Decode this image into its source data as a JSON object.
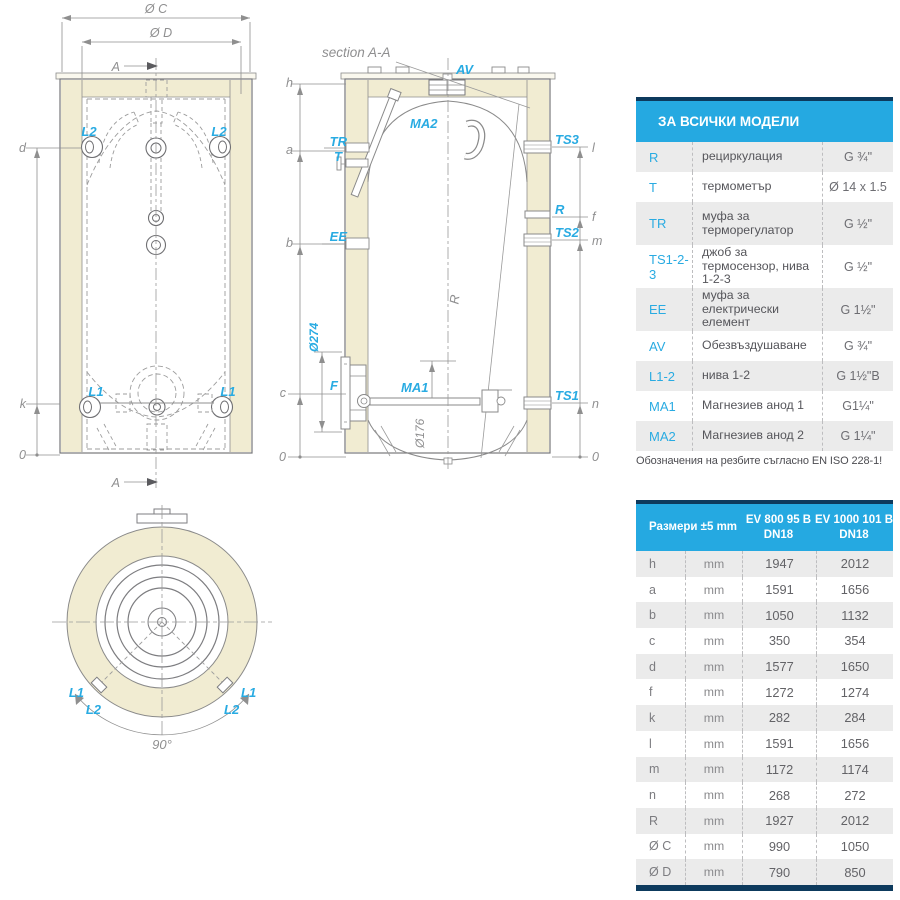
{
  "drawings": {
    "front_view": {
      "dim_c": "Ø C",
      "dim_d": "Ø D",
      "section_label": "A",
      "l2": "L2",
      "l1": "L1",
      "d": "d",
      "k": "k",
      "zero": "0"
    },
    "section_view": {
      "title": "section A-A",
      "av": "AV",
      "ma2": "MA2",
      "tr": "TR",
      "t": "T",
      "ee": "EE",
      "f_label": "F",
      "ma1": "MA1",
      "ts3": "TS3",
      "r_port": "R",
      "ts2": "TS2",
      "ts1": "TS1",
      "h": "h",
      "a": "a",
      "b": "b",
      "c": "c",
      "zero": "0",
      "l": "l",
      "f": "f",
      "m": "m",
      "n": "n",
      "r_dim": "R",
      "d274": "Ø274",
      "d176": "Ø176"
    },
    "top_view": {
      "l1": "L1",
      "l2": "L2",
      "angle": "90°"
    }
  },
  "table_models": {
    "title": "ЗА ВСИЧКИ МОДЕЛИ",
    "rows": [
      {
        "code": "R",
        "desc": "рециркулация",
        "value": "G ¾\""
      },
      {
        "code": "T",
        "desc": "термометър",
        "value": "Ø 14 x 1.5"
      },
      {
        "code": "TR",
        "desc": "муфа за терморегулатор",
        "value": "G ½\""
      },
      {
        "code": "TS1-2-3",
        "desc": "джоб за термосензор, нива 1-2-3",
        "value": "G ½\""
      },
      {
        "code": "EE",
        "desc": "муфа за електрически елемент",
        "value": "G 1½\""
      },
      {
        "code": "AV",
        "desc": "Обезвъздушаване",
        "value": "G ¾\""
      },
      {
        "code": "L1-2",
        "desc": "нива 1-2",
        "value": "G 1½\"B"
      },
      {
        "code": "MA1",
        "desc": "Магнезиев анод 1",
        "value": "G1¼\""
      },
      {
        "code": "MA2",
        "desc": "Магнезиев анод 2",
        "value": "G 1¼\""
      }
    ],
    "note": "Обозначения на резбите съгласно EN ISO 228-1!"
  },
  "table_dimensions": {
    "header": {
      "col1": "Размери ±5 mm",
      "col3": "EV 800 95 B DN18",
      "col4": "EV 1000 101 B DN18"
    },
    "rows": [
      {
        "dim": "h",
        "unit": "mm",
        "v1": "1947",
        "v2": "2012"
      },
      {
        "dim": "a",
        "unit": "mm",
        "v1": "1591",
        "v2": "1656"
      },
      {
        "dim": "b",
        "unit": "mm",
        "v1": "1050",
        "v2": "1132"
      },
      {
        "dim": "c",
        "unit": "mm",
        "v1": "350",
        "v2": "354"
      },
      {
        "dim": "d",
        "unit": "mm",
        "v1": "1577",
        "v2": "1650"
      },
      {
        "dim": "f",
        "unit": "mm",
        "v1": "1272",
        "v2": "1274"
      },
      {
        "dim": "k",
        "unit": "mm",
        "v1": "282",
        "v2": "284"
      },
      {
        "dim": "l",
        "unit": "mm",
        "v1": "1591",
        "v2": "1656"
      },
      {
        "dim": "m",
        "unit": "mm",
        "v1": "1172",
        "v2": "1174"
      },
      {
        "dim": "n",
        "unit": "mm",
        "v1": "268",
        "v2": "272"
      },
      {
        "dim": "R",
        "unit": "mm",
        "v1": "1927",
        "v2": "2012"
      },
      {
        "dim": "Ø C",
        "unit": "mm",
        "v1": "990",
        "v2": "1050"
      },
      {
        "dim": "Ø D",
        "unit": "mm",
        "v1": "790",
        "v2": "850"
      }
    ]
  },
  "colors": {
    "accent_blue": "#25a9e1",
    "navy": "#0d3a5d",
    "label_cyan": "#29abe2",
    "insulation": "#f1ecd2"
  }
}
